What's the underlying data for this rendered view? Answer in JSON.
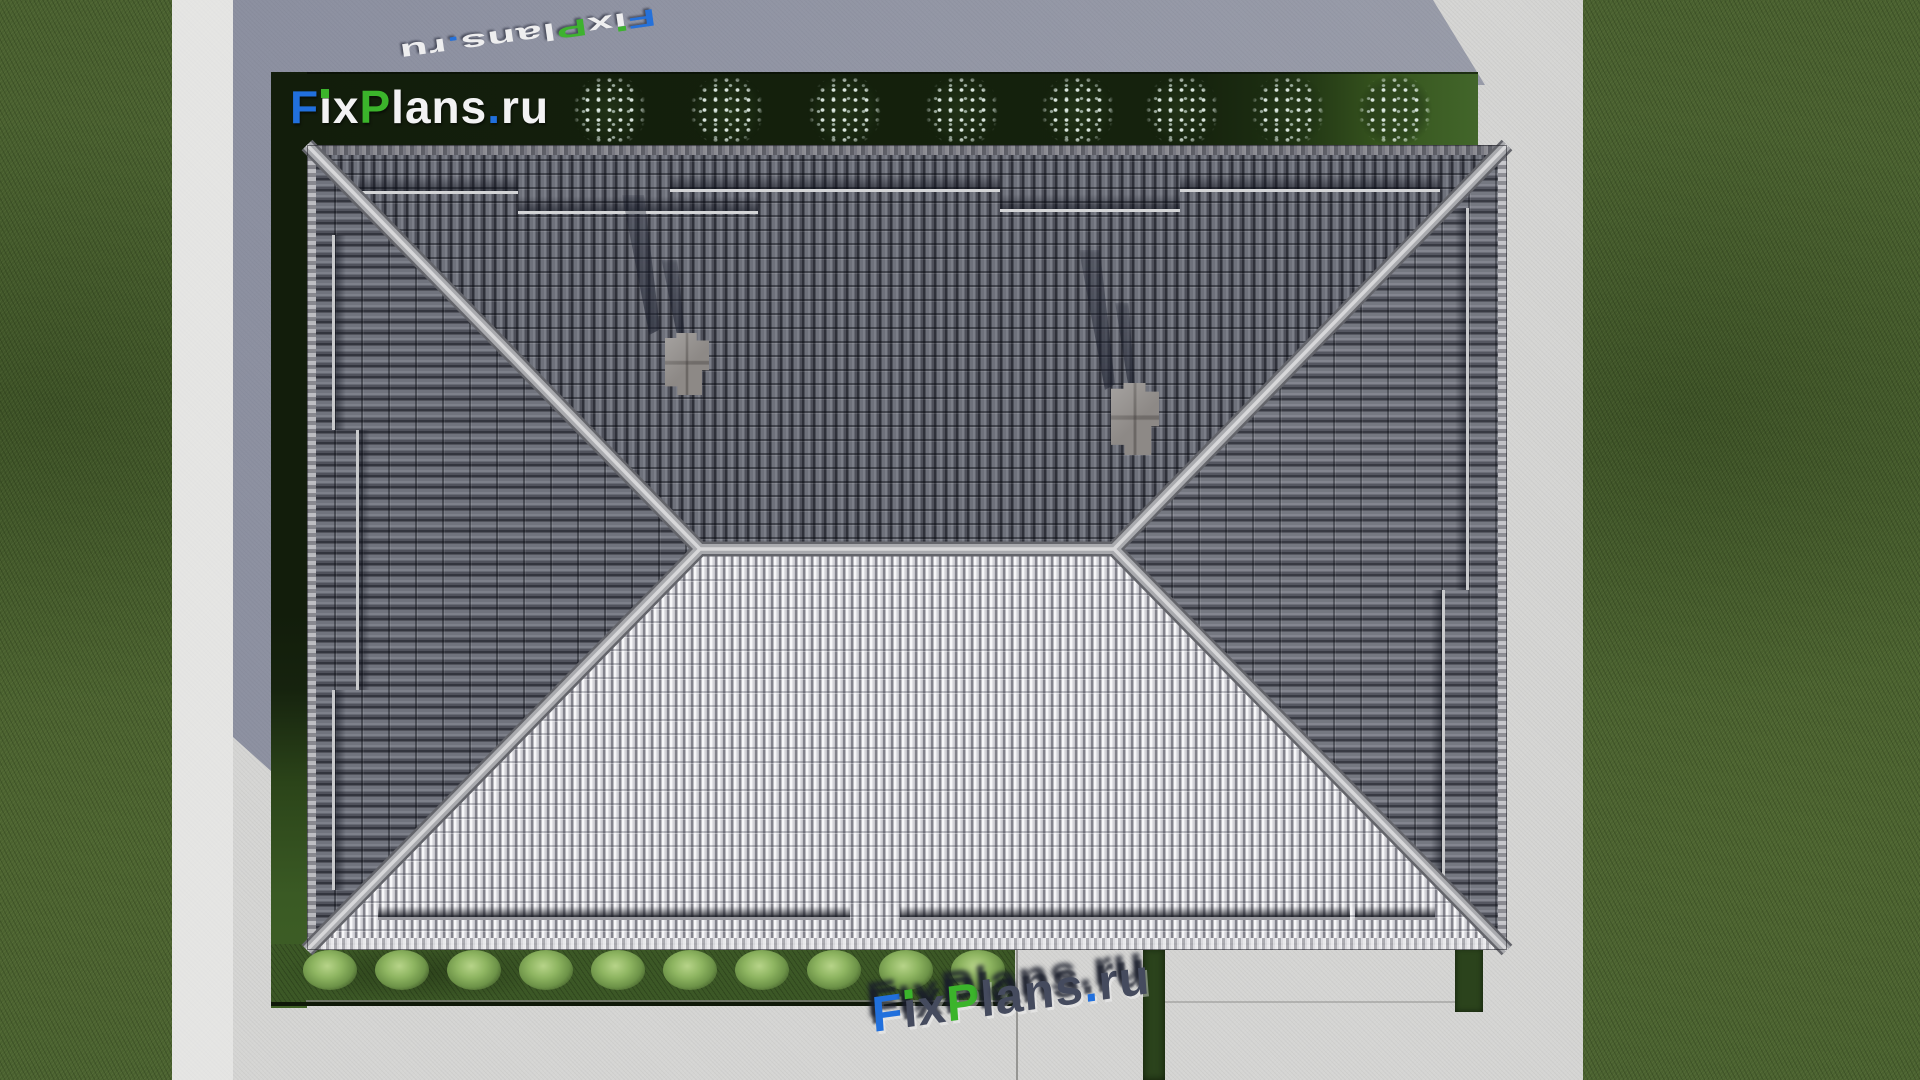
{
  "brand": {
    "text": "FixPlans.ru",
    "parts": [
      {
        "ch": "F",
        "color": "blue"
      },
      {
        "ch": "i",
        "color": "white",
        "tittle": "green"
      },
      {
        "ch": "x",
        "color": "white"
      },
      {
        "ch": "P",
        "color": "green"
      },
      {
        "ch": "l",
        "color": "white"
      },
      {
        "ch": "a",
        "color": "white"
      },
      {
        "ch": "n",
        "color": "white"
      },
      {
        "ch": "s",
        "color": "white"
      },
      {
        "ch": ".",
        "color": "blue"
      },
      {
        "ch": "r",
        "color": "white"
      },
      {
        "ch": "u",
        "color": "white"
      }
    ]
  },
  "watermarks": {
    "top": {
      "text": "FixPlans.ru"
    },
    "bottom": {
      "text": "FixPlans.ru"
    }
  },
  "palette": {
    "blue": "#2170dd",
    "green": "#3bb42b",
    "white": "#f2f2f3",
    "roof_dark_tiles": "#5b5d66",
    "roof_light_tiles": "#e6e6e9",
    "ridge": "#b0b1b4",
    "grass": "#49602f",
    "hedge_dark": "#14200c",
    "hedge_lit": "#3f6026",
    "garden_strip": "#3c5826",
    "bush_green": "#8fb765",
    "flower_white": "#dfeae2",
    "pavement": "#d5d5d3",
    "pavement_shadow": "#8e93a8",
    "chimney": "#8d8986"
  },
  "scene": {
    "type": "aerial-architecture-render",
    "roof_style": "hipped",
    "flower_shrub_count": 8,
    "garden_bush_count": 10,
    "chimney_count": 2
  }
}
